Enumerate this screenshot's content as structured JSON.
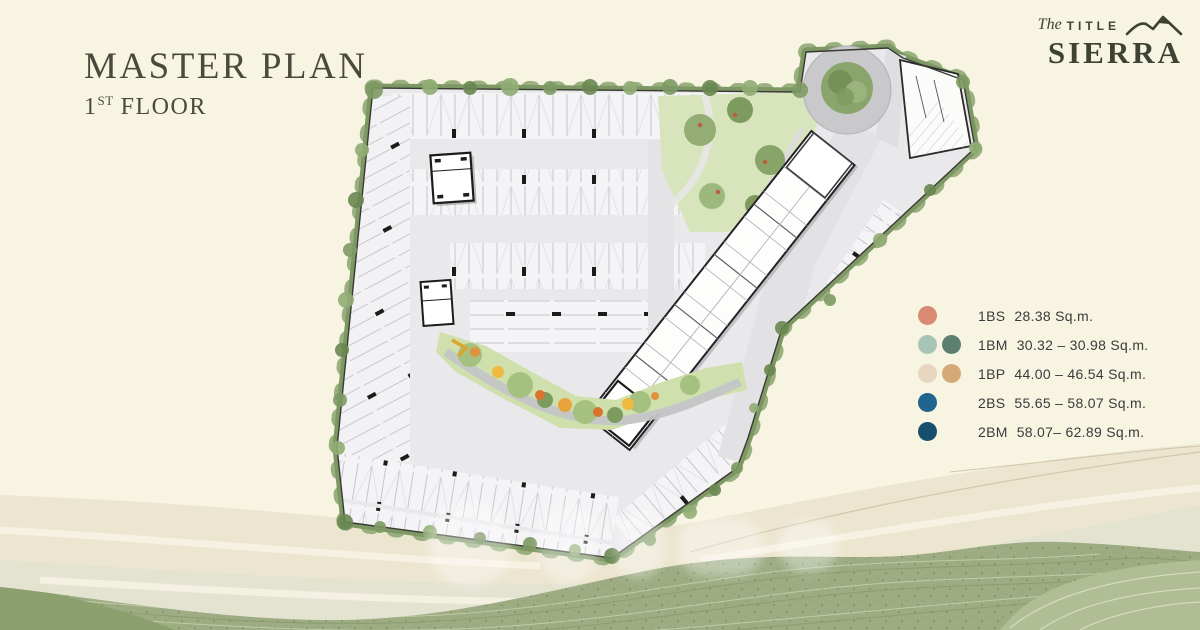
{
  "header": {
    "title": "MASTER PLAN",
    "floor_number": "1",
    "floor_ordinal": "ST",
    "floor_word": "FLOOR"
  },
  "logo": {
    "script_word": "The",
    "brand_word": "TITLE",
    "project_name": "SIERRA"
  },
  "legend": {
    "items": [
      {
        "code": "1BS",
        "area": "28.38 Sq.m.",
        "colors": [
          "#d98a72"
        ]
      },
      {
        "code": "1BM",
        "area": "30.32 – 30.98 Sq.m.",
        "colors": [
          "#a7c4b6",
          "#5c7f70"
        ]
      },
      {
        "code": "1BP",
        "area": "44.00 – 46.54 Sq.m.",
        "colors": [
          "#e7d7c1",
          "#d5a978"
        ]
      },
      {
        "code": "2BS",
        "area": "55.65 – 58.07 Sq.m.",
        "colors": [
          "#1f648e"
        ]
      },
      {
        "code": "2BM",
        "area": "58.07– 62.89 Sq.m.",
        "colors": [
          "#174e6d"
        ]
      }
    ]
  },
  "colors": {
    "background": "#f8f4e2",
    "heading_text": "#4a4a3c",
    "legend_text": "#3b3b3b",
    "hill_green": "#9dac83"
  }
}
